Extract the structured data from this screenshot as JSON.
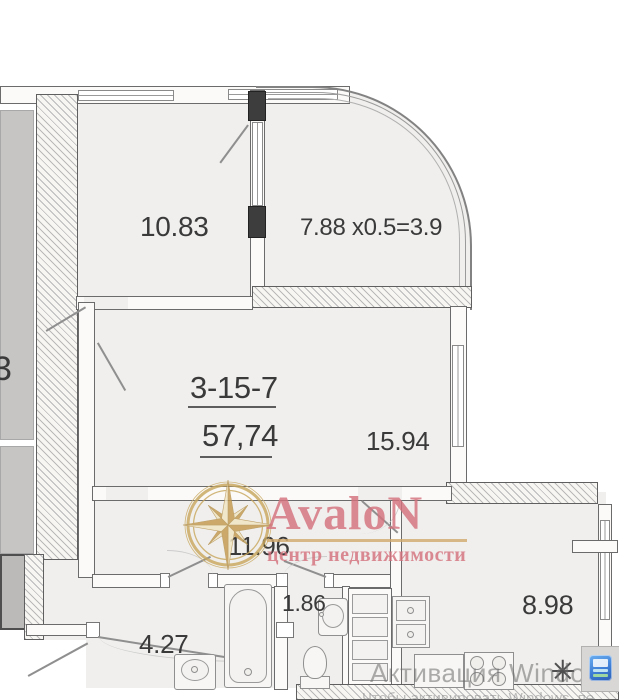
{
  "floorplan": {
    "unit_number": "3-15-7",
    "total_area": "57,74",
    "rooms": {
      "bedroom": "10.83",
      "balcony_formula": "7.88 x0.5=3.9",
      "living": "15.94",
      "hallway": "11.96",
      "bathroom": "4.27",
      "wc": "1.86",
      "kitchen": "8.98"
    },
    "neighbor_label_partial": "3"
  },
  "watermark": {
    "brand": "AvaloN",
    "tagline": "центр недвижимости",
    "brand_color": "#d4727d",
    "gold_color": "#cfa96a",
    "logo": "compass-rose"
  },
  "windows_activation": {
    "title": "Активация Windows",
    "subtitle": "Чтобы активировать Windows, пе"
  },
  "colors": {
    "floor": "#f0efed",
    "wall_line": "#6b6b6b",
    "activation_text": "#9c9c9c",
    "app_tile_blue": "#3f7ed6",
    "neighbor_gray": "#c6c5c4"
  }
}
